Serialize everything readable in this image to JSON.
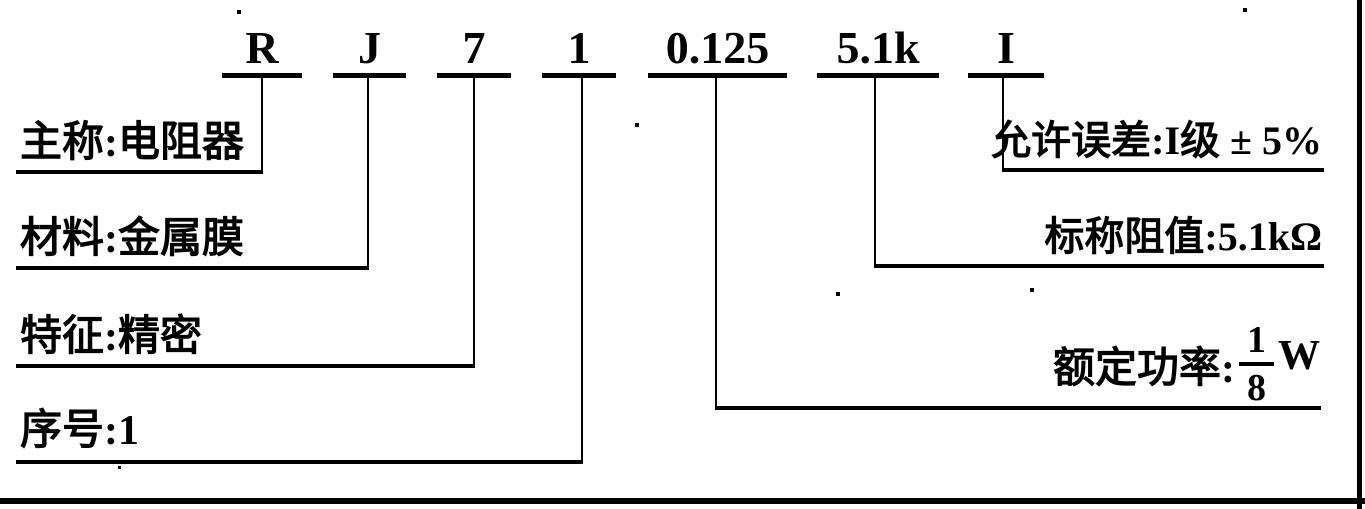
{
  "code": {
    "parts": [
      {
        "symbol": "R"
      },
      {
        "symbol": "J"
      },
      {
        "symbol": "7"
      },
      {
        "symbol": "1"
      },
      {
        "symbol": "0.125"
      },
      {
        "symbol": "5.1k"
      },
      {
        "symbol": "I"
      }
    ]
  },
  "labels": {
    "left": [
      {
        "text": "主称:电阻器"
      },
      {
        "text": "材料:金属膜"
      },
      {
        "text": "特征:精密"
      },
      {
        "text": "序号:1"
      }
    ],
    "right": [
      {
        "text": "允许误差:I级 ± 5%"
      },
      {
        "text": "标称阻值:5.1kΩ"
      },
      {
        "prefix": "额定功率:",
        "fraction": {
          "numerator": "1",
          "denominator": "8"
        },
        "unit": "W"
      }
    ]
  },
  "colors": {
    "ink": "#000000",
    "paper": "#ffffff"
  }
}
